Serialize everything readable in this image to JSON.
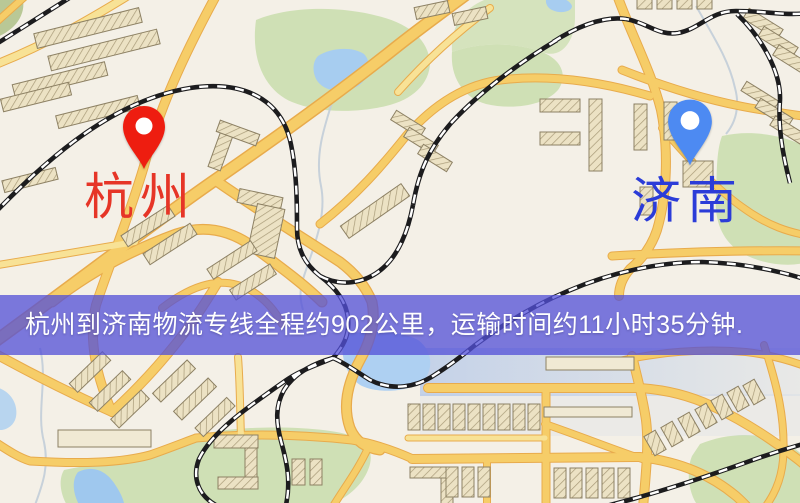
{
  "banner": {
    "text": "杭州到济南物流专线全程约902公里，运输时间约11小时35分钟.",
    "background_color": "#5350d7",
    "text_color": "#ffffff"
  },
  "markers": {
    "origin": {
      "label": "杭州",
      "pin_color": "#ee1d10",
      "label_color": "#e63527"
    },
    "destination": {
      "label": "济南",
      "pin_color": "#4d8af2",
      "label_color": "#2b3cd8"
    }
  },
  "route": {
    "origin_city": "杭州",
    "destination_city": "济南",
    "distance": "约902公里",
    "duration": "约11小时35分钟"
  },
  "map": {
    "palette": {
      "base": "#f4f0e7",
      "road": "#f6cd68",
      "road_casing": "#e8ab4c",
      "road_minor": "#f8e296",
      "park": "#cfe0b5",
      "water": "#a7cdf0",
      "building": "#ece2c4",
      "building_outline": "#8d8164",
      "railway": "#1c1c1e"
    }
  }
}
